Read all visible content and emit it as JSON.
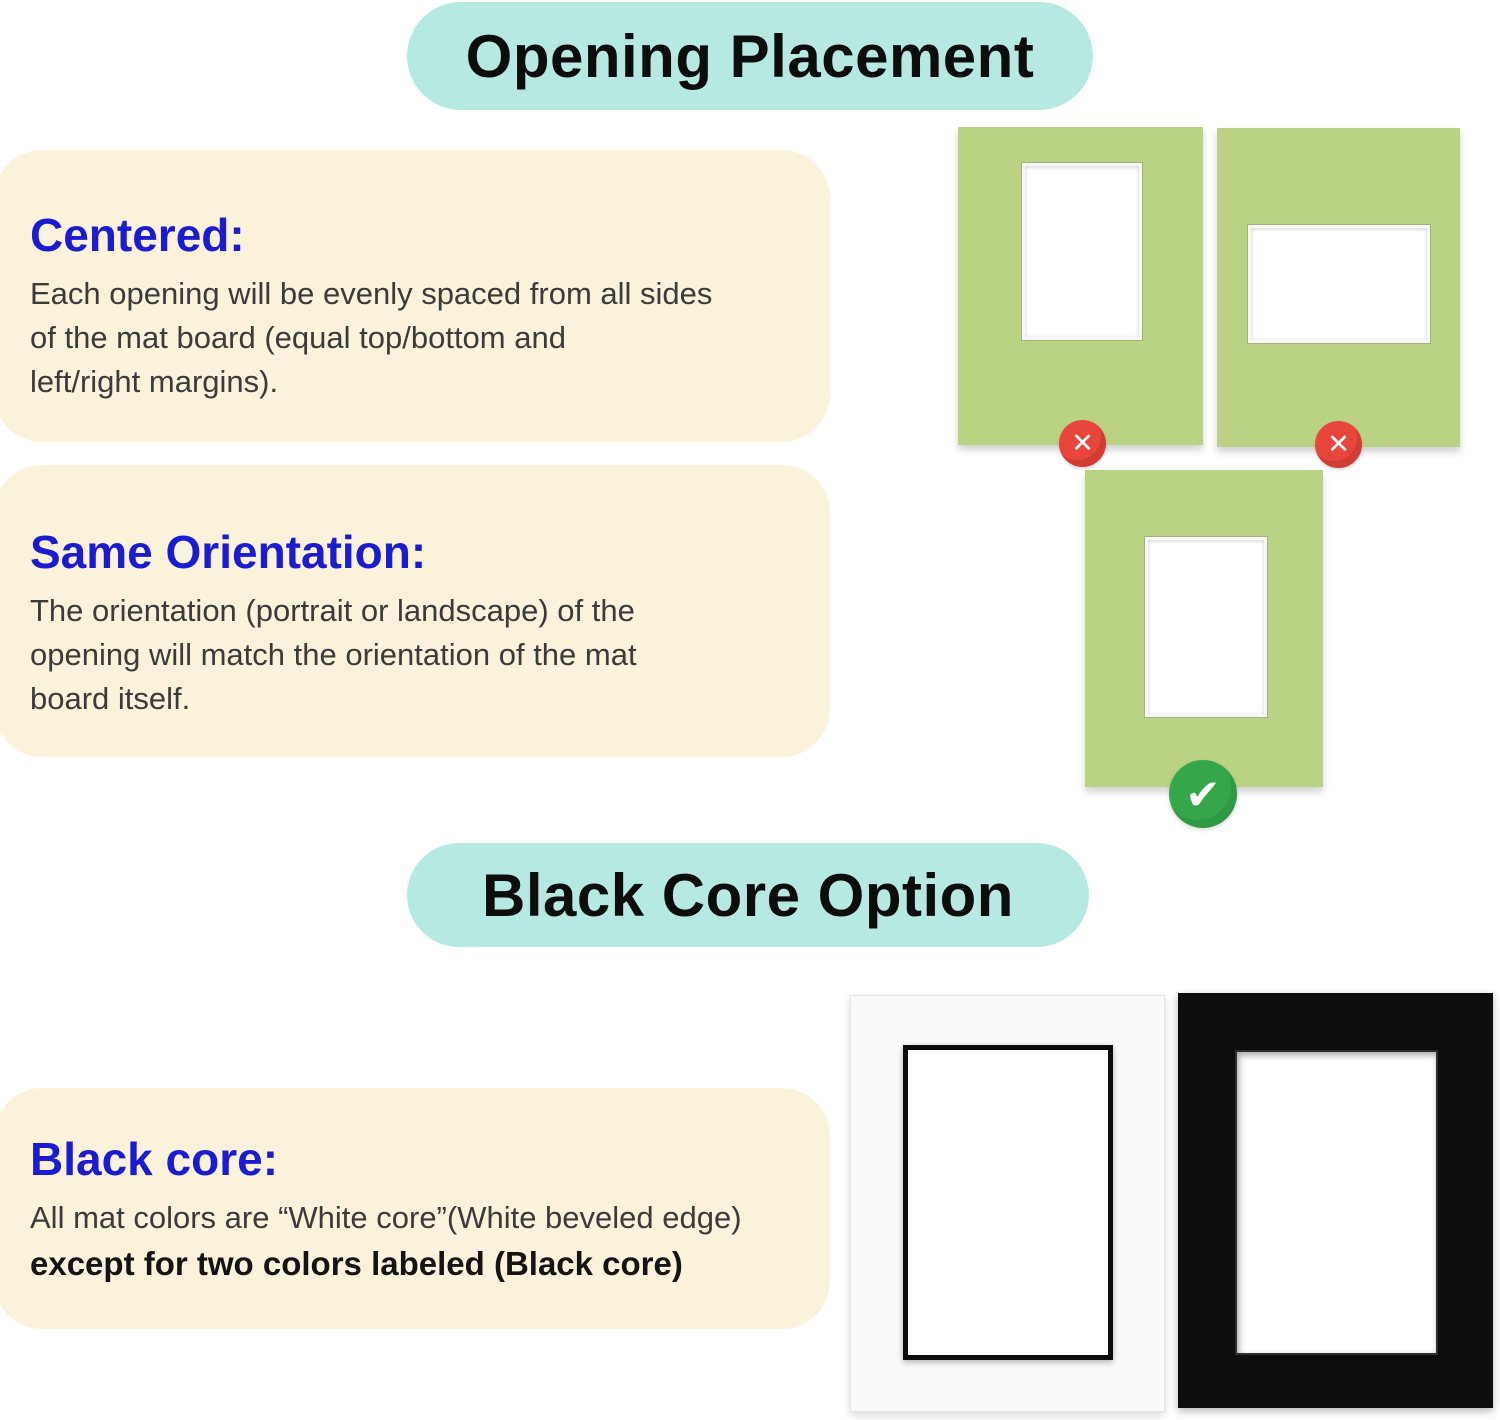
{
  "sections": {
    "opening_placement": {
      "title": "Opening Placement"
    },
    "black_core": {
      "title": "Black Core Option"
    }
  },
  "cards": {
    "centered": {
      "heading": "Centered:",
      "lines": [
        "Each opening will be evenly spaced from all sides",
        "of the mat board (equal top/bottom and",
        "left/right margins)."
      ]
    },
    "same_orientation": {
      "heading": "Same Orientation:",
      "lines": [
        "The orientation (portrait or landscape) of the",
        "opening will match the orientation of the mat",
        "board itself."
      ]
    },
    "black_core": {
      "heading": "Black core:",
      "line_regular": "All mat colors are “White core”(White beveled edge)",
      "line_bold": "except for two colors labeled (Black core)"
    }
  },
  "diagram": {
    "placement_examples": [
      {
        "name": "portrait-opening-too-high",
        "status": "incorrect"
      },
      {
        "name": "landscape-opening-wrong-orientation",
        "status": "incorrect"
      },
      {
        "name": "centered-portrait-opening",
        "status": "correct"
      }
    ],
    "core_examples": [
      {
        "name": "white-mat-with-black-core",
        "core": "black"
      },
      {
        "name": "black-mat-with-white-core",
        "core": "white"
      }
    ]
  },
  "icons": {
    "x_glyph": "✕",
    "check_glyph": "✔"
  },
  "colors": {
    "header_bg": "#b7e9e3",
    "card_bg": "#fbf2dc",
    "heading_blue": "#1b1bd1",
    "body_text": "#3b3b3b",
    "mat_green": "#b9d283",
    "error_red": "#e8453c",
    "success_green": "#36a64b",
    "mat_black": "#0d0d0d",
    "mat_white": "#fafafa"
  }
}
